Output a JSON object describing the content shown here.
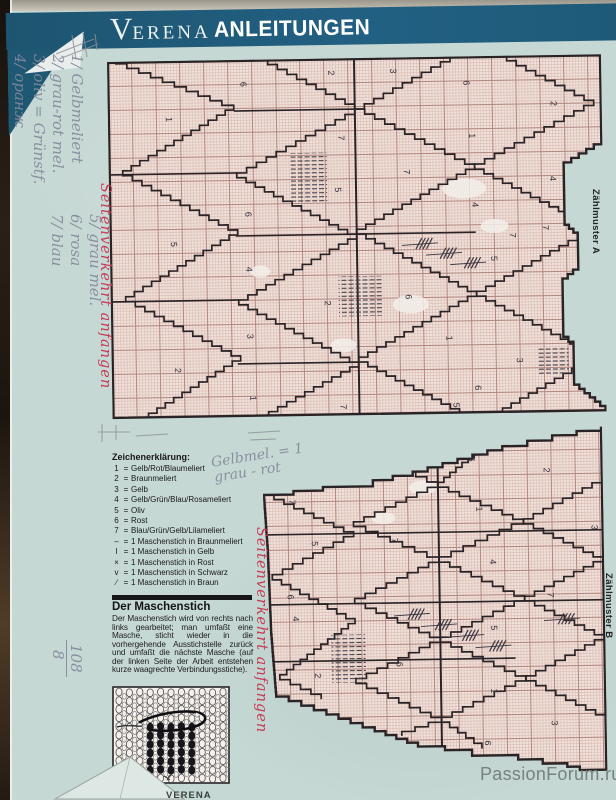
{
  "header": {
    "brand_v": "V",
    "brand_rest": "ERENA",
    "section": "ANLEITUNGEN"
  },
  "charts": {
    "a_label": "Zählmuster A",
    "b_label": "Zählmuster B",
    "a_numbers": [
      [
        58,
        56,
        "1"
      ],
      [
        133,
        22,
        "6"
      ],
      [
        221,
        12,
        "2"
      ],
      [
        283,
        11,
        "3"
      ],
      [
        356,
        24,
        "6"
      ],
      [
        443,
        46,
        "2"
      ],
      [
        230,
        77,
        "7"
      ],
      [
        361,
        77,
        "1"
      ],
      [
        295,
        112,
        "7"
      ],
      [
        226,
        129,
        "5"
      ],
      [
        363,
        146,
        "4"
      ],
      [
        441,
        121,
        "4"
      ],
      [
        136,
        152,
        "6"
      ],
      [
        400,
        177,
        "7"
      ],
      [
        433,
        170,
        "7"
      ],
      [
        61,
        181,
        "5"
      ],
      [
        381,
        200,
        "5"
      ],
      [
        136,
        207,
        "4"
      ],
      [
        214,
        242,
        "2"
      ],
      [
        295,
        237,
        "6"
      ],
      [
        136,
        274,
        "3"
      ],
      [
        335,
        279,
        "1"
      ],
      [
        63,
        307,
        "2"
      ],
      [
        405,
        302,
        "3"
      ],
      [
        363,
        329,
        "6"
      ],
      [
        138,
        336,
        "1"
      ],
      [
        228,
        346,
        "7"
      ],
      [
        341,
        346,
        "5"
      ]
    ],
    "b_numbers": [
      [
        26,
        70,
        "7"
      ],
      [
        48,
        112,
        "5"
      ],
      [
        23,
        165,
        "6"
      ],
      [
        28,
        187,
        "4"
      ],
      [
        49,
        244,
        "2"
      ],
      [
        25,
        279,
        "3"
      ],
      [
        128,
        110,
        "7"
      ],
      [
        131,
        234,
        "6"
      ],
      [
        206,
        30,
        "6"
      ],
      [
        281,
        42,
        "2"
      ],
      [
        213,
        80,
        "1"
      ],
      [
        226,
        133,
        "4"
      ],
      [
        226,
        199,
        "5"
      ],
      [
        225,
        262,
        "1"
      ],
      [
        283,
        167,
        "7"
      ],
      [
        328,
        100,
        "3"
      ],
      [
        285,
        295,
        "3"
      ],
      [
        218,
        314,
        "6"
      ],
      [
        291,
        337,
        "7"
      ]
    ]
  },
  "legend": {
    "title": "Zeichenerklärung:",
    "items": [
      {
        "sym": "1",
        "text": "Gelb/Rot/Blaumeliert"
      },
      {
        "sym": "2",
        "text": "Braunmeliert"
      },
      {
        "sym": "3",
        "text": "Gelb"
      },
      {
        "sym": "4",
        "text": "Gelb/Grün/Blau/Rosameliert"
      },
      {
        "sym": "5",
        "text": "Oliv"
      },
      {
        "sym": "6",
        "text": "Rost"
      },
      {
        "sym": "7",
        "text": "Blau/Grün/Gelb/Lilameliert"
      },
      {
        "sym": "–",
        "text": "1 Maschenstich in Braunmeliert"
      },
      {
        "sym": "I",
        "text": "1 Maschenstich in Gelb"
      },
      {
        "sym": "×",
        "text": "1 Maschenstich in Rost"
      },
      {
        "sym": "v",
        "text": "1 Maschenstich in Schwarz"
      },
      {
        "sym": "∕",
        "text": "1 Maschenstich in Braun"
      }
    ]
  },
  "maschenstich": {
    "title": "Der Maschenstich",
    "body": "Der Maschenstich wird von rechts nach links gearbeitet; man umfaßt eine Masche, sticht wieder in die vorhergehende Ausstichstelle zurück und umfaßt die nächste Masche (auf der linken Seite der Arbeit entstehen kurze waagrechte Verbindungsstiche)."
  },
  "annotations": {
    "red1": "Seitenverkehrt anfangen",
    "red2": "Seitenverkehrt anfangen",
    "block1": [
      "1/ Gelbmeliert",
      "2/ grau-rot mel.",
      "3/ oliv = Grünstf.",
      "4/ оранж"
    ],
    "block2": [
      "5/ grau mel.",
      "6/ rosa",
      "7/ blau"
    ],
    "note1": "Gelbmel. = 1",
    "note2": "grau - rot",
    "frac_top": "108",
    "frac_bottom": "8"
  },
  "footer": {
    "watermark": "PassionForum.ru",
    "brand": "VERENA"
  },
  "colors": {
    "header_teal": "#1e5a78",
    "chart_bg": "#f0e3dc",
    "grid_fine": "#d9b8b0",
    "grid_major": "#b2887f",
    "pattern_line": "#2a2326",
    "red_ink": "#c83a54",
    "pencil": "#84889b",
    "watermark_gray": "#77827f",
    "page_bg": "#c6d8d4"
  }
}
